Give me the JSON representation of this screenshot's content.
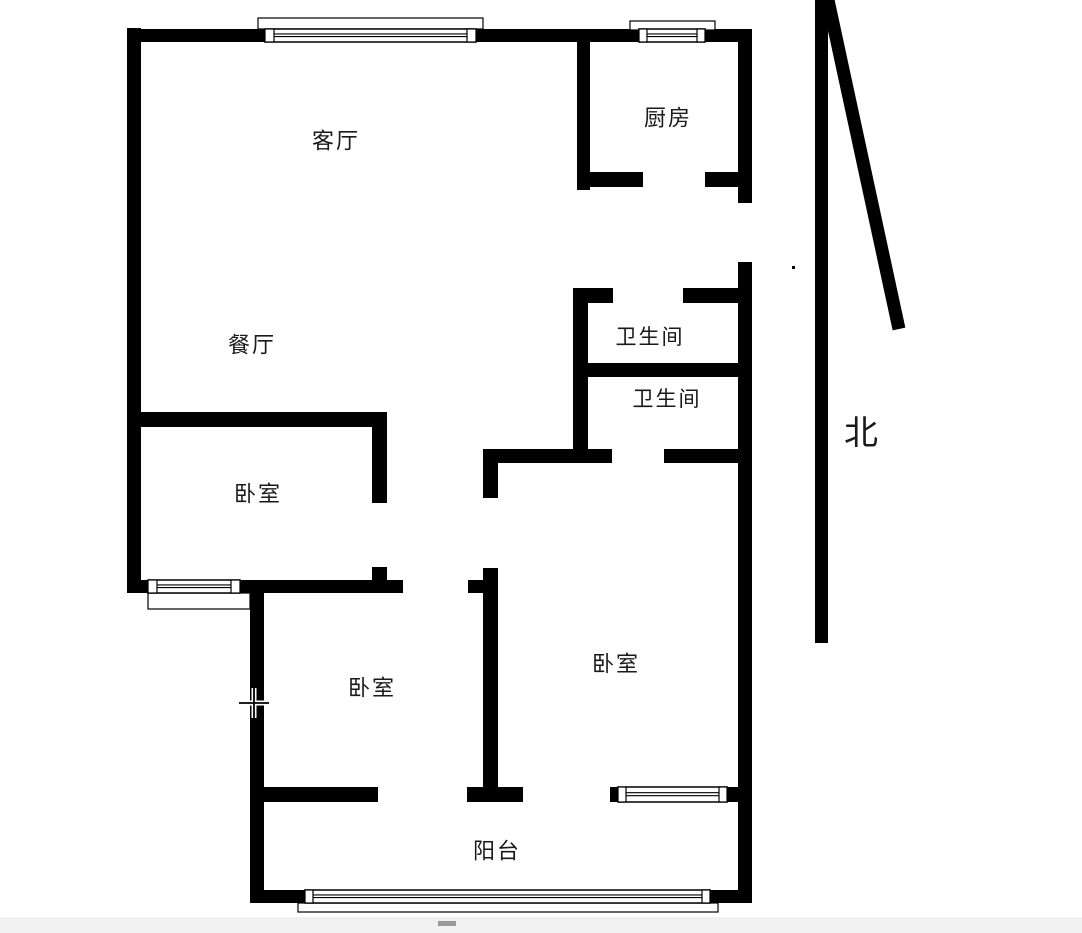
{
  "floorplan": {
    "colors": {
      "wall": "#000000",
      "background": "#ffffff",
      "window_fill": "#ffffff",
      "line": "#000000",
      "footer_bar": "#f1f1f1",
      "footer_dash": "#999999",
      "label_text": "#1a1a1a"
    },
    "labels": [
      {
        "id": "living-room",
        "text": "客厅",
        "x": 336,
        "y": 141,
        "size": 22
      },
      {
        "id": "kitchen",
        "text": "厨房",
        "x": 668,
        "y": 118,
        "size": 22
      },
      {
        "id": "dining-room",
        "text": "餐厅",
        "x": 252,
        "y": 345,
        "size": 22
      },
      {
        "id": "bathroom-1",
        "text": "卫生间",
        "x": 650,
        "y": 337,
        "size": 21
      },
      {
        "id": "bathroom-2",
        "text": "卫生间",
        "x": 667,
        "y": 399,
        "size": 21
      },
      {
        "id": "bedroom-1",
        "text": "卧室",
        "x": 258,
        "y": 494,
        "size": 22
      },
      {
        "id": "bedroom-2",
        "text": "卧室",
        "x": 372,
        "y": 688,
        "size": 22
      },
      {
        "id": "bedroom-3",
        "text": "卧室",
        "x": 616,
        "y": 664,
        "size": 22
      },
      {
        "id": "balcony",
        "text": "阳台",
        "x": 497,
        "y": 851,
        "size": 22
      }
    ],
    "north": {
      "label": "北",
      "label_x": 861,
      "label_y": 434,
      "label_size": 34,
      "shaft": {
        "x": 815,
        "y": 0,
        "w": 13,
        "h": 643
      },
      "diagonal": {
        "x1": 828,
        "y1": 0,
        "x2": 899,
        "y2": 329,
        "width": 13
      }
    },
    "walls": [
      {
        "id": "exterior-left",
        "x": 127,
        "y": 28,
        "w": 14,
        "h": 565
      },
      {
        "id": "exterior-top-a",
        "x": 127,
        "y": 29,
        "w": 138,
        "h": 13
      },
      {
        "id": "exterior-top-b",
        "x": 476,
        "y": 29,
        "w": 163,
        "h": 13
      },
      {
        "id": "exterior-top-c",
        "x": 705,
        "y": 29,
        "w": 47,
        "h": 13
      },
      {
        "id": "exterior-right-upper",
        "x": 738,
        "y": 29,
        "w": 14,
        "h": 174
      },
      {
        "id": "exterior-right-lower",
        "x": 738,
        "y": 262,
        "w": 14,
        "h": 641
      },
      {
        "id": "bedroom1-bottom-a",
        "x": 141,
        "y": 580,
        "w": 8,
        "h": 13
      },
      {
        "id": "bedroom1-bottom-b",
        "x": 240,
        "y": 580,
        "w": 163,
        "h": 13
      },
      {
        "id": "lower-left-wall",
        "x": 250,
        "y": 580,
        "w": 14,
        "h": 323
      },
      {
        "id": "exterior-bottom-a",
        "x": 250,
        "y": 890,
        "w": 56,
        "h": 13
      },
      {
        "id": "exterior-bottom-b",
        "x": 710,
        "y": 890,
        "w": 42,
        "h": 13
      },
      {
        "id": "kitchen-left",
        "x": 577,
        "y": 42,
        "w": 13,
        "h": 148
      },
      {
        "id": "kitchen-bottom-a",
        "x": 577,
        "y": 172,
        "w": 66,
        "h": 15
      },
      {
        "id": "kitchen-bottom-b",
        "x": 705,
        "y": 172,
        "w": 33,
        "h": 15
      },
      {
        "id": "bathroom-left",
        "x": 573,
        "y": 288,
        "w": 15,
        "h": 175
      },
      {
        "id": "bathroom-top-a",
        "x": 573,
        "y": 288,
        "w": 40,
        "h": 15
      },
      {
        "id": "bathroom-top-b",
        "x": 683,
        "y": 288,
        "w": 55,
        "h": 15
      },
      {
        "id": "bathroom-middle",
        "x": 573,
        "y": 363,
        "w": 165,
        "h": 14
      },
      {
        "id": "bathroom-bottom-a",
        "x": 483,
        "y": 449,
        "w": 129,
        "h": 14
      },
      {
        "id": "bathroom-bottom-b",
        "x": 664,
        "y": 449,
        "w": 74,
        "h": 14
      },
      {
        "id": "bedroom3-left-stub",
        "x": 483,
        "y": 449,
        "w": 15,
        "h": 49
      },
      {
        "id": "bedroom3-left",
        "x": 483,
        "y": 568,
        "w": 15,
        "h": 222
      },
      {
        "id": "bedroom2-door-tab",
        "x": 468,
        "y": 580,
        "w": 15,
        "h": 13
      },
      {
        "id": "bedroom1-top",
        "x": 127,
        "y": 412,
        "w": 260,
        "h": 15
      },
      {
        "id": "bedroom1-right-a",
        "x": 372,
        "y": 427,
        "w": 15,
        "h": 76
      },
      {
        "id": "bedroom1-right-b",
        "x": 372,
        "y": 567,
        "w": 15,
        "h": 26
      },
      {
        "id": "bedroom2-bottom",
        "x": 250,
        "y": 787,
        "w": 128,
        "h": 15
      },
      {
        "id": "bedroom2-bottom-block",
        "x": 467,
        "y": 787,
        "w": 56,
        "h": 15
      },
      {
        "id": "bedroom3-bottom-a",
        "x": 610,
        "y": 787,
        "w": 8,
        "h": 15
      },
      {
        "id": "bedroom3-bottom-b",
        "x": 727,
        "y": 787,
        "w": 11,
        "h": 15
      },
      {
        "id": "speck-dot",
        "x": 792,
        "y": 266,
        "w": 3,
        "h": 3
      }
    ],
    "windows": [
      {
        "id": "living-room-window",
        "band": [
          265,
          29,
          211,
          13
        ],
        "tabs": [
          [
            265,
            29,
            9,
            13
          ],
          [
            467,
            29,
            9,
            13
          ]
        ],
        "frame": [
          258,
          18,
          225,
          11
        ]
      },
      {
        "id": "kitchen-window",
        "band": [
          639,
          29,
          66,
          13
        ],
        "tabs": [
          [
            639,
            29,
            8,
            13
          ],
          [
            697,
            29,
            8,
            13
          ]
        ],
        "frame": [
          630,
          21,
          85,
          9
        ]
      },
      {
        "id": "bedroom1-window",
        "band": [
          148,
          580,
          92,
          13
        ],
        "tabs": [
          [
            148,
            580,
            9,
            13
          ],
          [
            231,
            580,
            9,
            13
          ]
        ],
        "frame": [
          148,
          593,
          102,
          16
        ]
      },
      {
        "id": "balcony-window",
        "band": [
          305,
          890,
          405,
          13
        ],
        "tabs": [
          [
            305,
            890,
            8,
            13
          ],
          [
            702,
            890,
            8,
            13
          ]
        ],
        "frame": [
          298,
          903,
          420,
          9
        ]
      },
      {
        "id": "bedroom3-window",
        "band": [
          618,
          787,
          109,
          15
        ],
        "tabs": [
          [
            618,
            787,
            8,
            15
          ],
          [
            719,
            787,
            8,
            15
          ]
        ],
        "frame": null
      }
    ],
    "cursor": {
      "x": 254,
      "y": 703,
      "arm": 15
    },
    "footer": {
      "bar": [
        0,
        917,
        1082,
        16
      ],
      "dash": [
        438,
        921,
        18,
        5
      ]
    }
  }
}
